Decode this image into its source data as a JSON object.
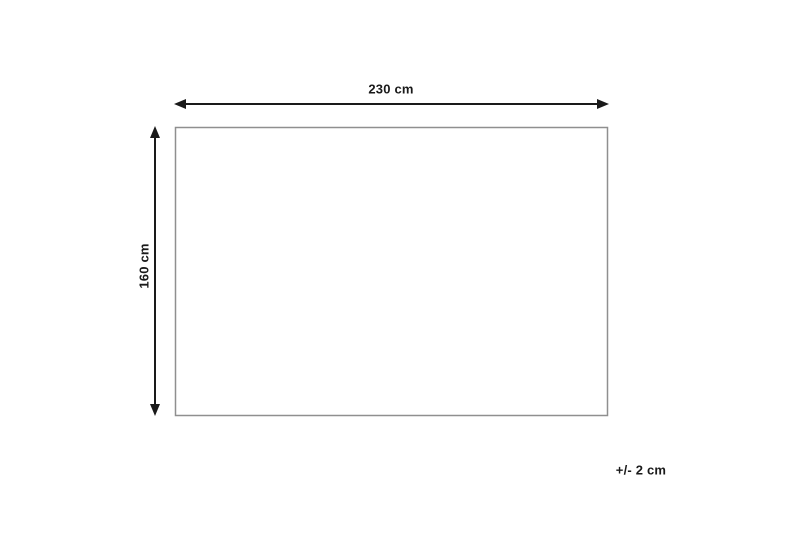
{
  "diagram": {
    "type": "product-dimension-diagram",
    "shape": "rectangle",
    "width_label": "230 cm",
    "height_label": "160 cm",
    "tolerance_label": "+/- 2 cm",
    "width_value_cm": 230,
    "height_value_cm": 160,
    "tolerance_value_cm": 2
  },
  "colors": {
    "background": "#ffffff",
    "outline": "#8f8f8f",
    "arrow": "#1a1a1a",
    "text": "#1a1a1a",
    "shape_fill": "#ffffff"
  }
}
